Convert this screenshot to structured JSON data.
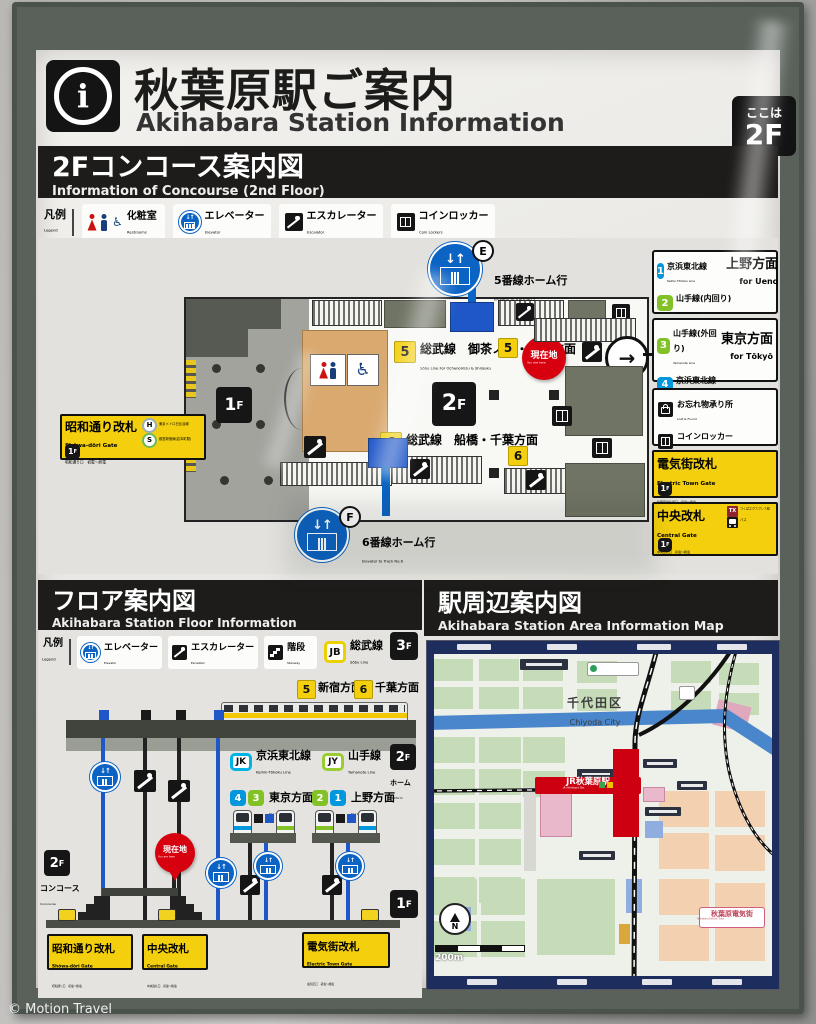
{
  "watermark": "© Motion Travel",
  "colors": {
    "accent_yellow": "#f3cf0e",
    "keihin_tohoku_blue": "#0097dc",
    "yamanote_green": "#83c226",
    "sobu_jb_yellow": "#f0d000",
    "alert_red": "#d7000f",
    "elevator_blue": "#0b63c4",
    "frame_green_gray": "#59615a"
  },
  "icons": {
    "info": "i",
    "elevator_arrows": "↓↑",
    "right_arrow": "→",
    "wheelchair": "♿"
  },
  "floors": {
    "f1": "1",
    "f2": "2",
    "f3": "3",
    "suffix": "F"
  },
  "header": {
    "title_ja": "秋葉原駅ご案内",
    "title_en": "Akihabara Station Information",
    "here_label": "ここは",
    "here_floor": "2F"
  },
  "concourse": {
    "title_ja": "2Fコンコース案内図",
    "title_en": "Information of Concourse (2nd Floor)",
    "legend": {
      "ja": "凡例",
      "en": "Legend",
      "restrooms_ja": "化粧室",
      "restrooms_en": "Restrooms",
      "elevator_ja": "エレベーター",
      "elevator_en": "Elevator",
      "escalator_ja": "エスカレーター",
      "escalator_en": "Escalator",
      "lockers_ja": "コインロッカー",
      "lockers_en": "Coin Lockers"
    },
    "map": {
      "elevator_e_letter": "E",
      "elevator_e_ja": "5番線ホーム行",
      "elevator_e_en": "Elevator to Track No.5",
      "elevator_f_letter": "F",
      "elevator_f_ja": "6番線ホーム行",
      "elevator_f_en": "Elevator to Track No.6",
      "track5_num": "5",
      "track5_ja": "総武線　御茶ノ水・新宿方面",
      "track5_en": "Sōbu Line   For Ochanomizu & Shinjuku",
      "track6_num": "6",
      "track6_ja": "総武線　船橋・千葉方面",
      "track6_en": "Sōbu Line   For Funabashi & Chiba",
      "here_ja": "現在地",
      "here_en": "You are here",
      "showa_ja": "昭和通り改札",
      "showa_en": "Shōwa-dōri Gate",
      "showa_sub": "昭和通り口　初電～終電",
      "hibiya_symbol": "H",
      "hibiya_ja": "東京メトロ日比谷線",
      "hibiya_en": "Subway Hibiya Line",
      "shinjuku_symbol": "S",
      "shinjuku_ja": "都営新宿線(岩本町駅)",
      "shinjuku_en": "Subway Shinjuku Line (Iwamotochō Sta.)"
    },
    "sidebar": {
      "ueno": {
        "l1_num": "1",
        "l1_ja": "京浜東北線",
        "l1_en": "Keihin-Tōhoku Line",
        "l2_num": "2",
        "l2_ja": "山手線(内回り)",
        "l2_en": "Yamanote Line",
        "via_ja": "1F コンコース経由",
        "via_en": "via 1st floor Concourse",
        "dir_ja": "上野方面",
        "dir_en": "for Ueno"
      },
      "tokyo": {
        "l1_num": "3",
        "l1_ja": "山手線(外回り)",
        "l1_en": "Yamanote Line",
        "l2_num": "4",
        "l2_ja": "京浜東北線",
        "l2_en": "Keihin-Tōhoku Line",
        "via_ja": "1F コンコース経由",
        "via_en": "via 1st floor Concourse",
        "dir_ja": "東京方面",
        "dir_en": "for Tōkyō"
      },
      "lost_ja": "お忘れ物承り所",
      "lost_en": "Lost & Found",
      "locker_ja": "コインロッカー",
      "locker_en": "Coin Lockers",
      "electric_ja": "電気街改札",
      "electric_en": "Electric Town Gate",
      "electric_sub": "秋葉原電気街口　初電～終電",
      "central_ja": "中央改札",
      "central_en": "Central Gate",
      "central_sub": "中央改札口　初電～終電",
      "tx_symbol": "TX",
      "tx_ja": "つくばエクスプレス線",
      "tx_en": "Tsukuba Express Line",
      "bus_ja": "バス",
      "bus_en": "Bus"
    }
  },
  "floor": {
    "title_ja": "フロア案内図",
    "title_en": "Akihabara Station Floor Information",
    "legend": {
      "ja": "凡例",
      "en": "Legend",
      "elevator_ja": "エレベーター",
      "elevator_en": "Elevator",
      "escalator_ja": "エスカレーター",
      "escalator_en": "Escalator",
      "stairs_ja": "階段",
      "stairs_en": "Stairway"
    },
    "jb": "JB",
    "jb_ja": "総武線",
    "jb_en": "Sōbu Line",
    "dir5_num": "5",
    "dir5_ja": "新宿方面",
    "dir5_en": "for Shinjuku",
    "dir6_num": "6",
    "dir6_ja": "千葉方面",
    "dir6_en": "for Chiba",
    "jk": "JK",
    "jk_ja": "京浜東北線",
    "jk_en": "Keihin-Tōhoku Line",
    "jy": "JY",
    "jy_ja": "山手線",
    "jy_en": "Yamanote Line",
    "platform_ja": "ホーム",
    "platform_en": "Platform",
    "tokyo_n1": "4",
    "tokyo_n2": "3",
    "tokyo_ja": "東京方面",
    "tokyo_en": "for Tōkyō",
    "ueno_n1": "2",
    "ueno_n2": "1",
    "ueno_ja": "上野方面",
    "ueno_en": "for Ueno",
    "here_ja": "現在地",
    "here_en": "You are here",
    "concourse_ja": "コンコース",
    "concourse_en": "Concourse",
    "gate1_ja": "昭和通り改札",
    "gate1_en": "Shōwa-dōri Gate",
    "gate1_sub": "昭和通り口　初電～終電",
    "gate2_ja": "中央改札",
    "gate2_en": "Central Gate",
    "gate2_sub": "中央改札口　初電～終電",
    "gate3_ja": "電気街改札",
    "gate3_en": "Electric Town Gate",
    "gate3_sub": "電気街口　初電～終電"
  },
  "area": {
    "title_ja": "駅周辺案内図",
    "title_en": "Akihabara Station Area Information Map",
    "district_ja": "千代田区",
    "district_en": "Chiyoda City",
    "station_ja": "JR秋葉原駅",
    "station_en": "JR Akihabara Sta.",
    "etown_ja": "秋葉原電気街",
    "etown_en": "Akihabara Electric Town",
    "scale": "200m",
    "north": "N"
  }
}
